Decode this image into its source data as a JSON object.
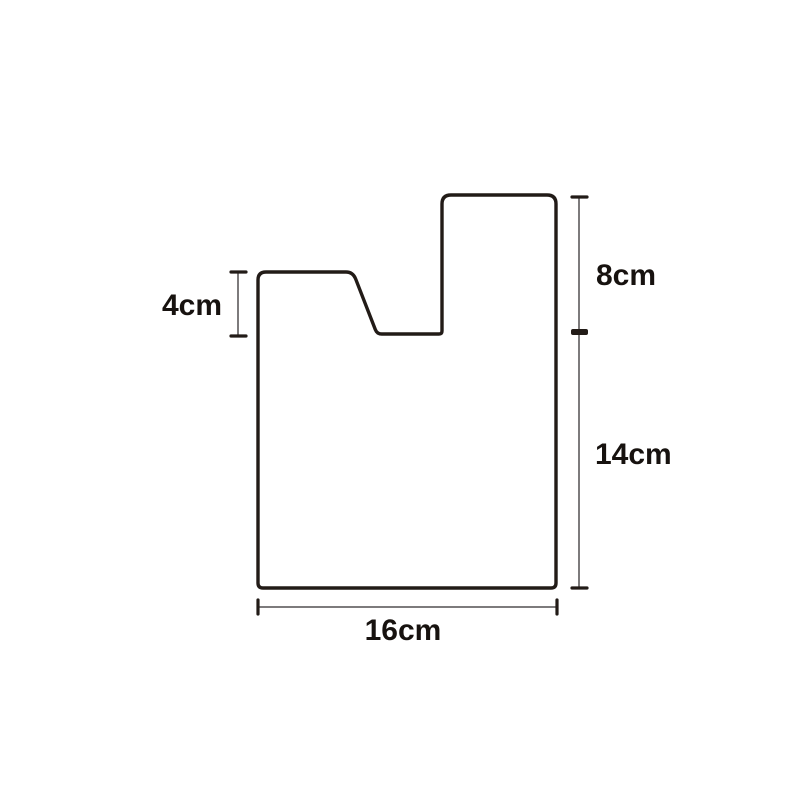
{
  "figure": {
    "description": "Notched polygon outline with dimension annotations",
    "colors": {
      "outline": "#221b17",
      "dimension_line": "#7d7b7c",
      "tick": "#221b17",
      "text": "#17120f",
      "background": "#ffffff"
    },
    "dimensions": {
      "left_notch_height": "4cm",
      "right_upper_height": "8cm",
      "right_lower_height": "14cm",
      "bottom_width": "16cm"
    }
  }
}
